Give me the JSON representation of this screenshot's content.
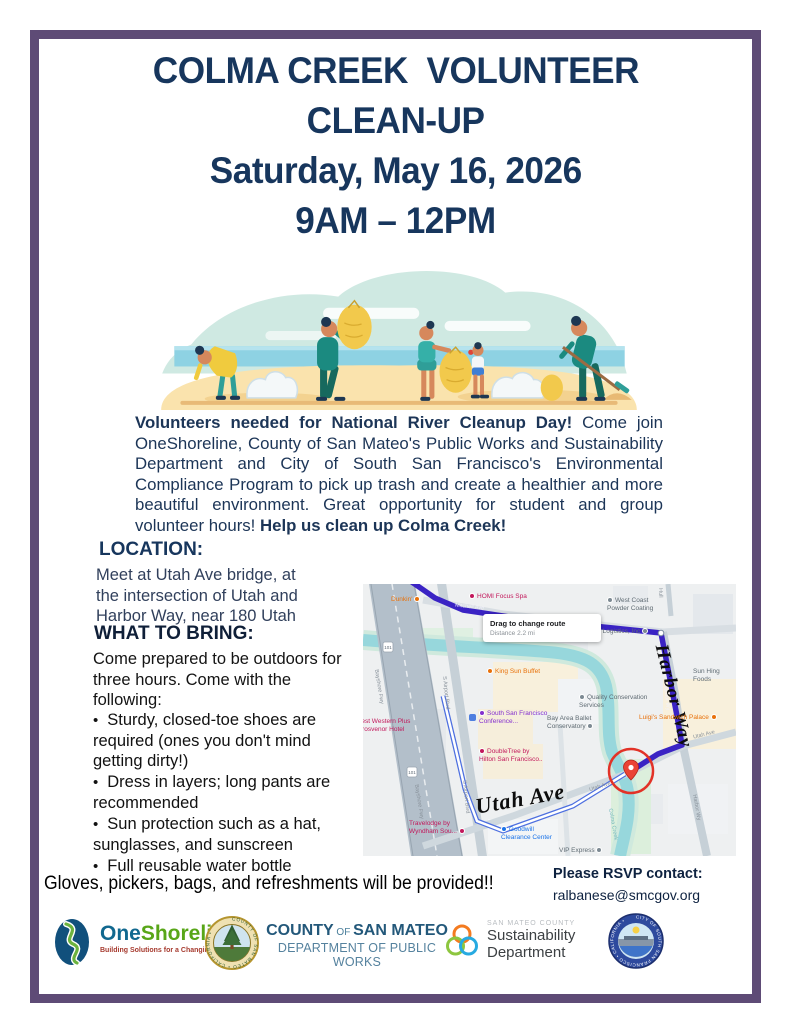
{
  "flyer": {
    "title_lines": [
      "COLMA CREEK  VOLUNTEER",
      "CLEAN-UP",
      "Saturday, May 16, 2026",
      "9AM – 12PM"
    ],
    "intro": {
      "bold_lead": "Volunteers needed for National River Cleanup Day!",
      "body": " Come join OneShoreline, County of San Mateo's Public Works and Sustainability Department and City of South San Francisco's Environmental Compliance Program to pick up trash and create a healthier and more beautiful environment. Great opportunity for student and group volunteer hours! ",
      "bold_tail": "Help us clean up Colma Creek!"
    },
    "location": {
      "heading": "LOCATION:",
      "lines": [
        "Meet at Utah Ave bridge, at",
        "the intersection of Utah and",
        "Harbor Way, near 180 Utah"
      ]
    },
    "bring": {
      "heading": "WHAT TO BRING:",
      "intro": "Come prepared to be outdoors for three hours. Come with the following:",
      "items": [
        "Sturdy, closed-toe shoes are required (ones you don't mind getting dirty!)",
        "Dress in layers; long pants are recommended",
        "Sun protection such as a hat, sunglasses, and sunscreen",
        "Full reusable water bottle"
      ]
    },
    "footer": {
      "provided": "Gloves, pickers, bags, and refreshments will be provided!!",
      "rsvp_label": "Please RSVP contact:",
      "rsvp_email": "ralbanese@smcgov.org"
    }
  },
  "map": {
    "tooltip": {
      "title": "Drag to change route",
      "distance": "Distance 2.2 mi"
    },
    "streets": {
      "utah_big": "Utah Ave",
      "harbor_big": "Harbor Way",
      "mitchell": "Mitchell Ave",
      "harbor_small": "Harbor Wy",
      "s_airport": "S Airport Blvd",
      "bayshore": "Bayshore Fwy",
      "utah_small": "Utah Ave",
      "hull": "Hull",
      "colma_creek": "Colma Creek",
      "shield": "101"
    },
    "pois": {
      "dunkin": "Dunkin'",
      "homi": "HOMI Focus Spa",
      "west_coast": "West Coast\nPowder Coating",
      "forward": "Forward Logistics, Inc",
      "king_sun": "King Sun Buffet",
      "quality": "Quality Conservation\nServices",
      "ssf_conference": "South San Francisco\nConference...",
      "ballet": "Bay Area Ballet\nConservatory",
      "luigis": "Luigi's Sandwich Palace",
      "sun_hing": "Sun Hing Foods",
      "doubletree": "DoubleTree by\nHilton San Francisco..",
      "hotel_left": "Best Western Plus\nGrosvenor Hotel",
      "travelodge": "Travelodge by\nWyndham Sou...",
      "goodwill": "Goodwill\nClearance Center",
      "vip": "VIP Express"
    }
  },
  "logos": {
    "oneshoreline": {
      "one": "One",
      "shoreline": "Shoreline",
      "tagline": "Building Solutions for a Changing Climate"
    },
    "smc_seal_text": "COUNTY OF SAN MATEO • CALIFORNIA •",
    "county": {
      "l1a": "COUNTY",
      "l1b": " OF ",
      "l1c": "SAN MATEO",
      "l2": "DEPARTMENT OF PUBLIC WORKS"
    },
    "sustainability": {
      "small": "SAN MATEO COUNTY",
      "line1": "Sustainability",
      "line2": "Department"
    },
    "ssf_seal_text": "CITY OF SOUTH SAN FRANCISCO • CALIFORNIA •"
  },
  "colors": {
    "border_purple": "#5e4b76",
    "title_navy": "#17365d",
    "route_indigo": "#3a23c4",
    "creek_teal": "#97d7dc",
    "marker_red": "#e23227"
  }
}
